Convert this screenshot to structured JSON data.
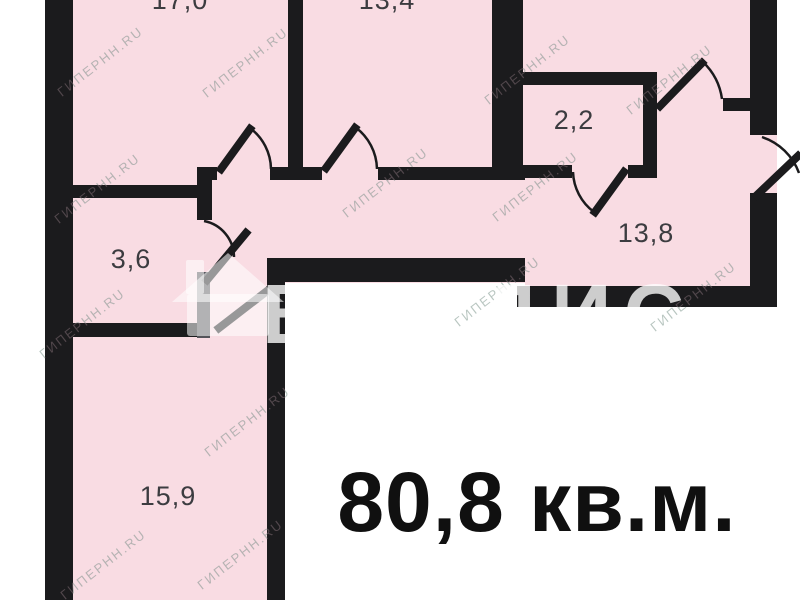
{
  "plan": {
    "total_area_label": "80,8 кв.м.",
    "rooms": [
      {
        "name": "room-17-0",
        "area_label": "17,0"
      },
      {
        "name": "room-13-4",
        "area_label": "13,4"
      },
      {
        "name": "room-2-2",
        "area_label": "2,2"
      },
      {
        "name": "room-13-8",
        "area_label": "13,8"
      },
      {
        "name": "room-3-6",
        "area_label": "3,6"
      },
      {
        "name": "room-15-9",
        "area_label": "15,9"
      }
    ],
    "colors": {
      "floor": "#f9dce3",
      "wall": "#1b1b1d",
      "door_leaf_gray": "#54545a",
      "label": "#3c3c40",
      "total_text": "#101010",
      "background": "#ffffff"
    },
    "watermarks": {
      "brand": "ВЛАДИС",
      "site": "ГИПЕРНН.RU",
      "logo": "house-icon"
    }
  }
}
